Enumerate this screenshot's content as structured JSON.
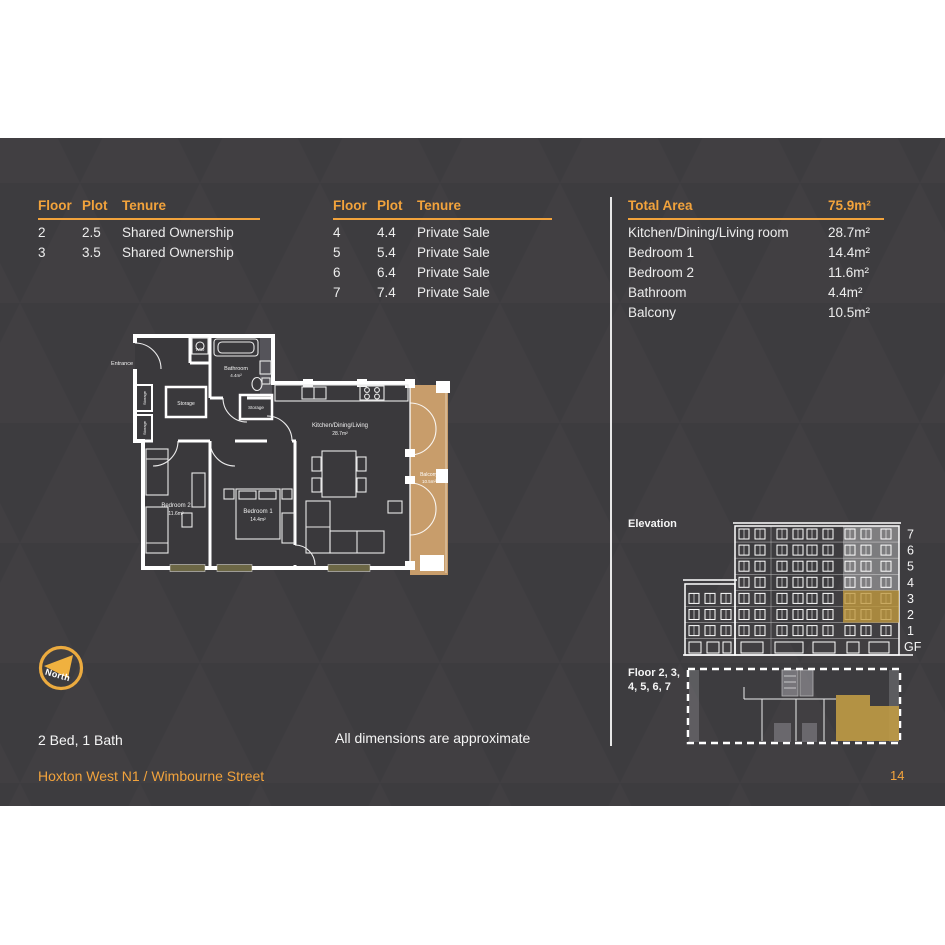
{
  "page": {
    "bed_bath": "2 Bed, 1 Bath",
    "dimensions_note": "All dimensions are approximate",
    "footer_address": "Hoxton West N1 / Wimbourne Street",
    "page_number": "14",
    "accent_color": "#F2A33C",
    "panel_color": "#3D3C3F",
    "balcony_color": "#C89D6B"
  },
  "tenure_tables": [
    {
      "headers": {
        "floor": "Floor",
        "plot": "Plot",
        "tenure": "Tenure"
      },
      "rows": [
        {
          "floor": "2",
          "plot": "2.5",
          "tenure": "Shared Ownership"
        },
        {
          "floor": "3",
          "plot": "3.5",
          "tenure": "Shared Ownership"
        }
      ]
    },
    {
      "headers": {
        "floor": "Floor",
        "plot": "Plot",
        "tenure": "Tenure"
      },
      "rows": [
        {
          "floor": "4",
          "plot": "4.4",
          "tenure": "Private Sale"
        },
        {
          "floor": "5",
          "plot": "5.4",
          "tenure": "Private Sale"
        },
        {
          "floor": "6",
          "plot": "6.4",
          "tenure": "Private Sale"
        },
        {
          "floor": "7",
          "plot": "7.4",
          "tenure": "Private Sale"
        }
      ]
    }
  ],
  "total_area": {
    "label": "Total Area",
    "value": "75.9m²",
    "rows": [
      {
        "label": "Kitchen/Dining/Living room",
        "value": "28.7m²"
      },
      {
        "label": "Bedroom 1",
        "value": "14.4m²"
      },
      {
        "label": "Bedroom 2",
        "value": "11.6m²"
      },
      {
        "label": "Bathroom",
        "value": "4.4m²"
      },
      {
        "label": "Balcony",
        "value": "10.5m²"
      }
    ]
  },
  "floor_plan": {
    "entrance": "Entrance",
    "wd": "W/D",
    "bathroom": "Bathroom",
    "bathroom_area": "4.4m²",
    "storage": "Storage",
    "kitchen": "Kitchen/Dining/Living",
    "kitchen_area": "28.7m²",
    "bedroom1": "Bedroom 1",
    "bedroom1_area": "14.4m²",
    "bedroom2": "Bedroom 2",
    "bedroom2_area": "11.6m²",
    "balcony": "Balcony",
    "balcony_area": "10.5m²"
  },
  "compass": {
    "label": "North"
  },
  "elevation": {
    "title": "Elevation",
    "floor_labels": [
      "7",
      "6",
      "5",
      "4",
      "3",
      "2",
      "1",
      "GF"
    ]
  },
  "key_plan": {
    "title_line1": "Floor 2, 3,",
    "title_line2": "4, 5, 6, 7"
  }
}
